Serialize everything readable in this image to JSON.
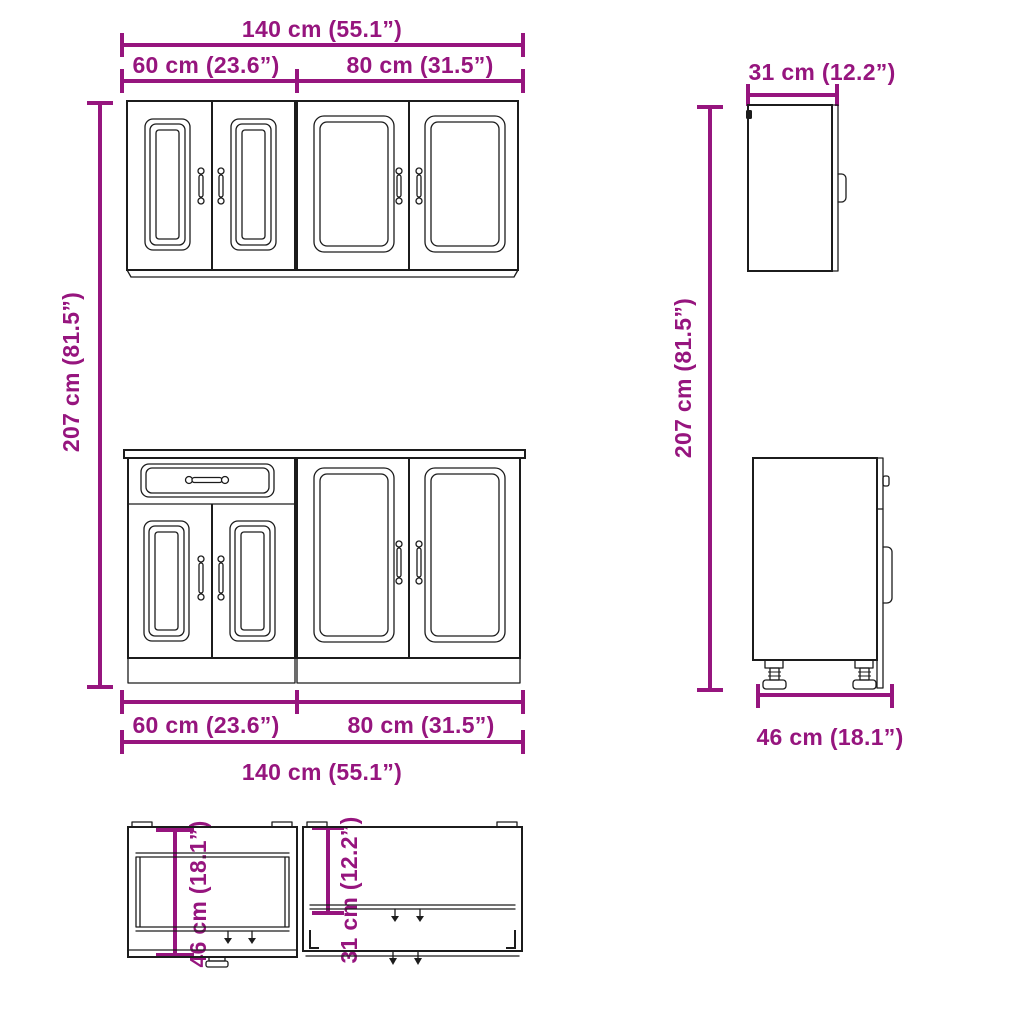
{
  "colors": {
    "accent": "#96157e",
    "line": "#1c1c1c",
    "bg": "#ffffff"
  },
  "labels": {
    "total_width": "140 cm (55.1”)",
    "left_unit_width": "60 cm (23.6”)",
    "right_unit_width": "80 cm (31.5”)",
    "cabinet_height": "207 cm (81.5”)",
    "wall_depth": "31 cm (12.2”)",
    "base_depth": "46 cm (18.1”)"
  }
}
